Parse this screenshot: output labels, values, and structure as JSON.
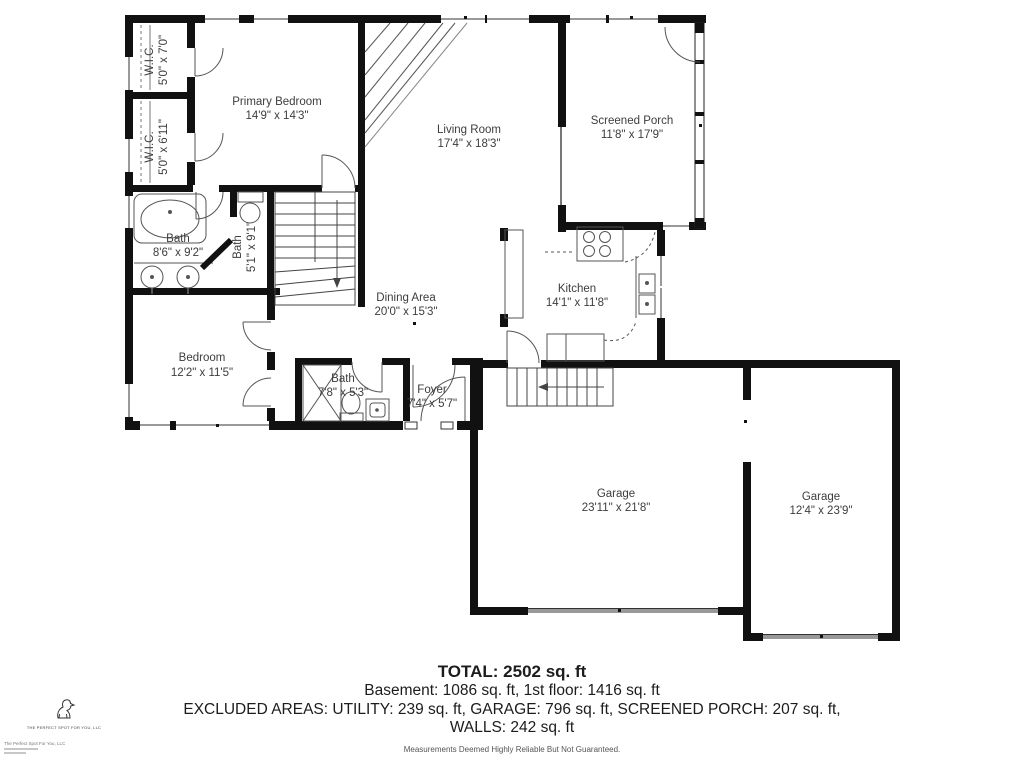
{
  "plan": {
    "rooms": {
      "wic1": {
        "name": "W.I.C.",
        "dims": "5'0\" x 7'0\""
      },
      "wic2": {
        "name": "W.I.C.",
        "dims": "5'0\" x 6'11\""
      },
      "primary_bedroom": {
        "name": "Primary Bedroom",
        "dims": "14'9\" x 14'3\""
      },
      "living_room": {
        "name": "Living Room",
        "dims": "17'4\" x 18'3\""
      },
      "screened_porch": {
        "name": "Screened Porch",
        "dims": "11'8\" x 17'9\""
      },
      "primary_bath": {
        "name": "Bath",
        "dims": "8'6\" x 9'2\""
      },
      "hall_bath": {
        "name": "Bath",
        "dims": "5'1\" x 9'1\""
      },
      "dining_area": {
        "name": "Dining Area",
        "dims": "20'0\" x 15'3\""
      },
      "kitchen": {
        "name": "Kitchen",
        "dims": "14'1\" x 11'8\""
      },
      "bedroom": {
        "name": "Bedroom",
        "dims": "12'2\" x 11'5\""
      },
      "bath3": {
        "name": "Bath",
        "dims": "7'8\" x 5'3\""
      },
      "foyer": {
        "name": "Foyer",
        "dims": "7'4\" x 5'7\""
      },
      "garage1": {
        "name": "Garage",
        "dims": "23'11\" x 21'8\""
      },
      "garage2": {
        "name": "Garage",
        "dims": "12'4\" x 23'9\""
      }
    }
  },
  "footer": {
    "total": "TOTAL: 2502 sq. ft",
    "line2": "Basement: 1086 sq. ft, 1st floor: 1416 sq. ft",
    "line3": "EXCLUDED AREAS: UTILITY: 239 sq. ft, GARAGE: 796 sq. ft, SCREENED PORCH: 207 sq. ft,",
    "line4": "WALLS: 242 sq. ft",
    "disclaimer": "Measurements Deemed Highly Reliable But Not Guaranteed."
  },
  "logo": {
    "company": "THE PERFECT SPOT FOR YOU, LLC",
    "fine_print": "The Perfect Spot For You, LLC"
  },
  "colors": {
    "wall": "#111111",
    "label": "#3d3d3d",
    "garage_door": "#999999"
  }
}
